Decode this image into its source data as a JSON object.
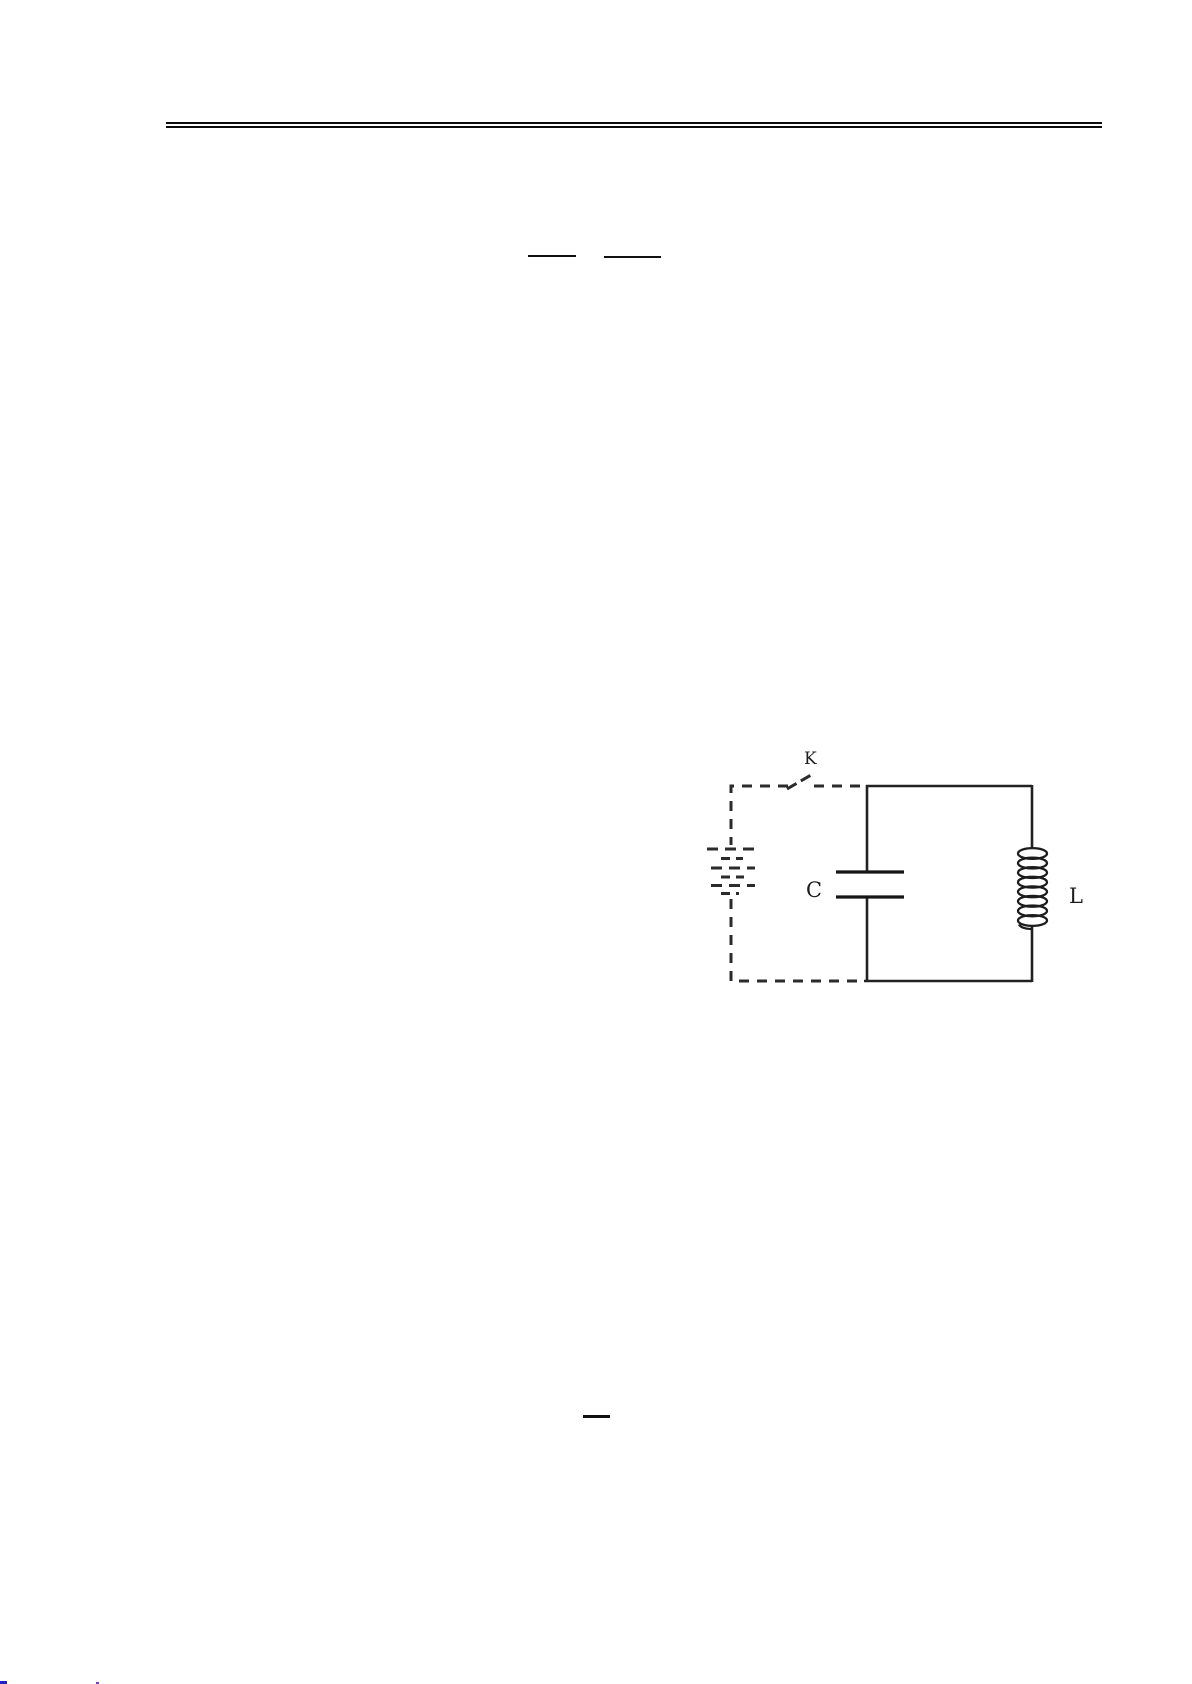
{
  "page": {
    "background": "#ffffff",
    "ink_color": "#222222"
  },
  "circuit": {
    "labels": {
      "switch": "K",
      "capacitor": "C",
      "inductor": "L"
    },
    "components": [
      "battery-dashed",
      "switch",
      "capacitor",
      "inductor-coil"
    ]
  },
  "footer": {
    "fragment_colors": [
      "#2121c8",
      "#7a3fc2"
    ]
  }
}
